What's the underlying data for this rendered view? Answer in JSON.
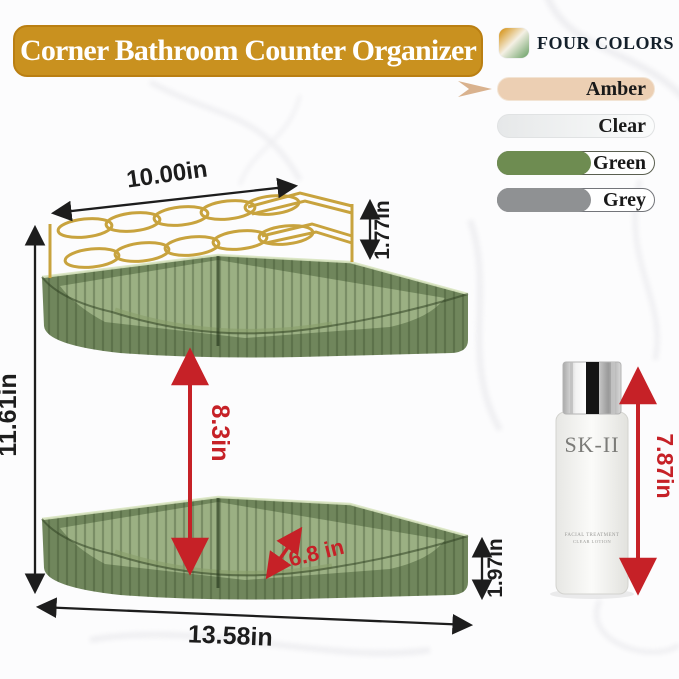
{
  "banner": {
    "title": "Corner Bathroom Counter Organizer"
  },
  "colors_panel": {
    "heading": "FOUR COLORS",
    "icon": "gradient-swatch-icon",
    "pointer": "arrow-pointer-icon",
    "swatches": [
      {
        "label": "Amber",
        "color": "#eccfb3"
      },
      {
        "label": "Clear",
        "color": "#e9ebec"
      },
      {
        "label": "Green",
        "color": "#6e8c51"
      },
      {
        "label": "Grey",
        "color": "#8f9193"
      }
    ]
  },
  "dimensions": {
    "top_width": "10.00in",
    "rack_height": "1.77in",
    "total_height": "11.61in",
    "tier_gap": "8.3in",
    "shelf_depth": "6.8 in",
    "tray_height": "1.97in",
    "base_width": "13.58in",
    "bottle_height": "7.87in"
  },
  "bottle": {
    "brand": "SK-II",
    "label_line1": "FACIAL TREATMENT",
    "label_line2": "CLEAR LOTION"
  },
  "palette": {
    "banner_gold": "#c9911f",
    "dimension_black": "#1d1d1d",
    "dimension_red": "#c62127",
    "product_green": "#5c7546",
    "frame_gold": "#c8a33e"
  }
}
